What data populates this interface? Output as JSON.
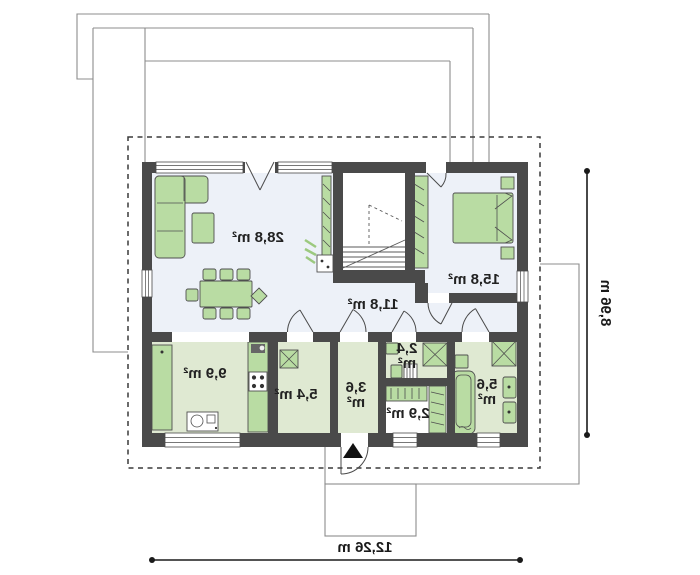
{
  "floorplan": {
    "title": "single-storey house floor plan (mirrored print)",
    "rooms": {
      "living": {
        "label": "28,8 m²"
      },
      "bedroom": {
        "label": "15,8 m²"
      },
      "hall": {
        "label": "11,8 m²"
      },
      "kitchen": {
        "label": "9,9 m²"
      },
      "utility": {
        "label": "5,4 m²"
      },
      "vestibule": {
        "line1": "3,6",
        "line2": "m²"
      },
      "wc": {
        "line1": "2,4",
        "line2": "m²"
      },
      "closet": {
        "label": "2,9 m²"
      },
      "bathroom": {
        "line1": "5,6",
        "line2": "m²"
      }
    },
    "dimensions": {
      "width": "12,26 m",
      "depth": "8,96 m"
    },
    "colors": {
      "wall": "#4a4a4a",
      "furniture_green": "#b9dca3",
      "floor_green": "#dfe9d2",
      "floor_light": "#edf1f8",
      "dimension_line": "#1a1a1a",
      "roof_line": "#8c8c8c"
    }
  }
}
